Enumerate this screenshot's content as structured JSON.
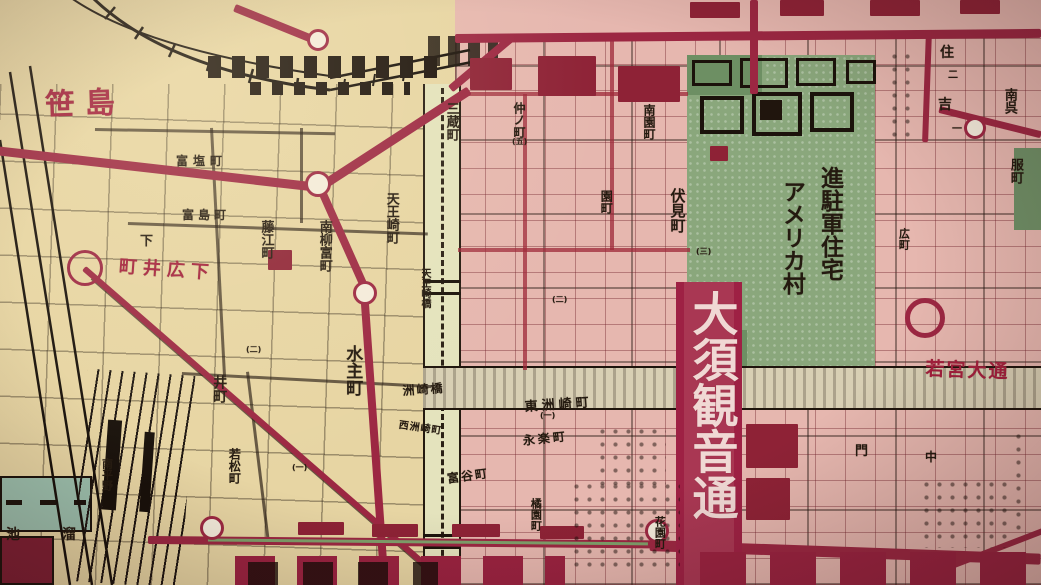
{
  "colors": {
    "paper_left": "#e7d5a3",
    "paper_right": "#e6b7af",
    "road_red": "#9c2742",
    "crimson_banner": "#9e2144",
    "banner_text": "#f0d8d4",
    "green_village": "#8aa77c",
    "canal": "#e4e3bd",
    "pond": "#9cc0ad",
    "ink": "#241a10",
    "red_text": "#a31f3c"
  },
  "labels": [
    {
      "id": "sasajima",
      "t": "笹島",
      "kind": "district",
      "x": 44,
      "y": 80,
      "fs": 30,
      "c": "red",
      "ls": 10,
      "w": 700,
      "rot": -2
    },
    {
      "id": "shimo-hiroi",
      "t": "町井広下",
      "reading": "下広井町",
      "kind": "town",
      "x": 120,
      "y": 252,
      "fs": 18,
      "c": "red",
      "rot": 4,
      "ls": 6,
      "w": 700
    },
    {
      "id": "osu-kannon-dori",
      "t": "大須観音通",
      "kind": "street",
      "x": 686,
      "y": 290,
      "fs": 46,
      "c": "white",
      "v": true,
      "lh": 1.12,
      "w": 700
    },
    {
      "id": "wakamiya-odori",
      "t": "若宮大通",
      "kind": "street",
      "x": 926,
      "y": 354,
      "fs": 19,
      "c": "red",
      "rot": 2,
      "ls": 2,
      "w": 700
    },
    {
      "id": "tomishima",
      "t": "富島町",
      "kind": "town",
      "x": 182,
      "y": 206,
      "fs": 12,
      "ls": 4
    },
    {
      "id": "tomishio",
      "t": "富塩町",
      "kind": "town",
      "x": 176,
      "y": 152,
      "fs": 12,
      "ls": 5
    },
    {
      "id": "shimo",
      "t": "下",
      "kind": "town",
      "x": 140,
      "y": 230,
      "fs": 13
    },
    {
      "id": "fujie",
      "t": "藤江町",
      "kind": "town",
      "x": 256,
      "y": 220,
      "fs": 13,
      "v": true,
      "lh": 1.5
    },
    {
      "id": "minami-yanagitomi",
      "t": "南柳富町",
      "kind": "town",
      "x": 312,
      "y": 220,
      "fs": 13,
      "v": true,
      "lh": 1.75
    },
    {
      "id": "kako-machi",
      "t": "水主町",
      "kind": "town",
      "x": 330,
      "y": 345,
      "fs": 17,
      "v": true,
      "lh": 2.6,
      "w": 700
    },
    {
      "id": "tennozaki",
      "t": "天王崎町",
      "kind": "town",
      "x": 378,
      "y": 192,
      "fs": 13,
      "v": true,
      "lh": 1.9
    },
    {
      "id": "i-cho",
      "t": "井町",
      "kind": "town",
      "x": 206,
      "y": 375,
      "fs": 14,
      "v": true,
      "lh": 1.8
    },
    {
      "id": "wakamatsu",
      "t": "若松町",
      "kind": "town",
      "x": 224,
      "y": 448,
      "fs": 12,
      "v": true,
      "lh": 1.7
    },
    {
      "id": "tameike",
      "t": "池　溜",
      "reading": "溜池",
      "kind": "pond",
      "x": 6,
      "y": 524,
      "fs": 14,
      "ls": 14
    },
    {
      "id": "minami-hirano",
      "t": "南平野",
      "kind": "town",
      "x": 98,
      "y": 458,
      "fs": 11,
      "v": true,
      "lh": 1.5
    },
    {
      "id": "suzaki-bashi",
      "t": "洲崎橋",
      "kind": "bridge",
      "x": 402,
      "y": 382,
      "fs": 12,
      "rot": -4,
      "ls": 2
    },
    {
      "id": "higashi-suzaki",
      "t": "東洲崎町",
      "kind": "town",
      "x": 524,
      "y": 396,
      "fs": 13,
      "rot": -4,
      "ls": 4
    },
    {
      "id": "nishi-suzaki",
      "t": "西洲崎町",
      "kind": "town",
      "x": 400,
      "y": 416,
      "fs": 10,
      "rot": 8,
      "ls": 1
    },
    {
      "id": "tennozaki-bashi",
      "t": "天王崎橋",
      "kind": "bridge",
      "x": 418,
      "y": 268,
      "fs": 10,
      "v": true,
      "lh": 1.3
    },
    {
      "id": "shinchugun-jutaku",
      "t": "進駐軍住宅",
      "kind": "district",
      "x": 814,
      "y": 166,
      "fs": 23,
      "v": true,
      "lh": 1.32,
      "w": 700
    },
    {
      "id": "america-mura",
      "t": "アメリカ村",
      "kind": "district",
      "x": 776,
      "y": 180,
      "fs": 23,
      "v": true,
      "lh": 1.32,
      "w": 700
    },
    {
      "id": "sanzo",
      "t": "三蔵町",
      "kind": "town",
      "x": 440,
      "y": 102,
      "fs": 13,
      "v": true,
      "lh": 1.6
    },
    {
      "id": "nakano-cho",
      "t": "仲ノ町",
      "kind": "town",
      "x": 510,
      "y": 102,
      "fs": 12,
      "v": true,
      "lh": 1.5
    },
    {
      "id": "minami-sono",
      "t": "南園町",
      "kind": "town",
      "x": 640,
      "y": 104,
      "fs": 12,
      "v": true,
      "lh": 1.5
    },
    {
      "id": "sono-machi",
      "t": "園町",
      "kind": "town",
      "x": 596,
      "y": 190,
      "fs": 12,
      "v": true,
      "lh": 1.6
    },
    {
      "id": "fushimi",
      "t": "伏見町",
      "kind": "town",
      "x": 663,
      "y": 188,
      "fs": 15,
      "v": true,
      "lh": 1.9,
      "w": 700
    },
    {
      "id": "sumiyoshi-1",
      "t": "住",
      "kind": "town",
      "x": 940,
      "y": 42,
      "fs": 14
    },
    {
      "id": "sumiyoshi-block2",
      "t": "二",
      "kind": "block-number",
      "x": 948,
      "y": 66,
      "fs": 10
    },
    {
      "id": "sumiyoshi-2",
      "t": "吉",
      "kind": "town",
      "x": 938,
      "y": 94,
      "fs": 14
    },
    {
      "id": "sumiyoshi-block1",
      "t": "一",
      "kind": "block-number",
      "x": 952,
      "y": 120,
      "fs": 10
    },
    {
      "id": "minami-gofuku-a",
      "t": "南呉",
      "kind": "town",
      "x": 1000,
      "y": 88,
      "fs": 13,
      "v": true,
      "lh": 1.3
    },
    {
      "id": "minami-gofuku-b",
      "t": "服町",
      "kind": "town",
      "x": 1006,
      "y": 158,
      "fs": 13,
      "v": true,
      "lh": 1.3
    },
    {
      "id": "eiraku",
      "t": "永楽町",
      "kind": "town",
      "x": 522,
      "y": 432,
      "fs": 12,
      "rot": -6,
      "ls": 3
    },
    {
      "id": "tomitani",
      "t": "富谷町",
      "kind": "town",
      "x": 446,
      "y": 470,
      "fs": 12,
      "rot": -8,
      "ls": 2
    },
    {
      "id": "hanazono",
      "t": "花園町",
      "kind": "town",
      "x": 652,
      "y": 516,
      "fs": 11,
      "v": true,
      "lh": 1.4
    },
    {
      "id": "monzen",
      "t": "門",
      "kind": "town",
      "x": 855,
      "y": 440,
      "fs": 13
    },
    {
      "id": "naka",
      "t": "中",
      "kind": "town",
      "x": 925,
      "y": 448,
      "fs": 12
    },
    {
      "id": "kitsuen",
      "t": "橘園町",
      "kind": "town",
      "x": 528,
      "y": 498,
      "fs": 11,
      "v": true,
      "lh": 1.4
    },
    {
      "id": "hiro-cho",
      "t": "広町",
      "kind": "town",
      "x": 896,
      "y": 228,
      "fs": 11,
      "v": true,
      "lh": 1.4
    },
    {
      "id": "block-no-1",
      "t": "(一)",
      "kind": "block-number",
      "x": 292,
      "y": 462,
      "fs": 8
    },
    {
      "id": "block-no-2",
      "t": "(二)",
      "kind": "block-number",
      "x": 246,
      "y": 344,
      "fs": 8
    },
    {
      "id": "block-no-5",
      "t": "(五)",
      "kind": "block-number",
      "x": 512,
      "y": 136,
      "fs": 8
    },
    {
      "id": "block-no-2b",
      "t": "(二)",
      "kind": "block-number",
      "x": 552,
      "y": 294,
      "fs": 8
    },
    {
      "id": "block-no-1b",
      "t": "(一)",
      "kind": "block-number",
      "x": 540,
      "y": 410,
      "fs": 8
    },
    {
      "id": "block-no-3",
      "t": "(三)",
      "kind": "block-number",
      "x": 696,
      "y": 246,
      "fs": 8
    }
  ],
  "tram_stops": [
    {
      "x": 318,
      "y": 184,
      "r": 13
    },
    {
      "x": 365,
      "y": 293,
      "r": 12
    },
    {
      "x": 212,
      "y": 528,
      "r": 12
    },
    {
      "x": 657,
      "y": 531,
      "r": 12
    },
    {
      "x": 925,
      "y": 318,
      "r": 20,
      "ring_only": true,
      "thick": 5
    },
    {
      "x": 85,
      "y": 268,
      "r": 18,
      "ring_only": true,
      "thick": 3
    },
    {
      "x": 975,
      "y": 128,
      "r": 11
    },
    {
      "x": 318,
      "y": 40,
      "r": 11
    }
  ]
}
